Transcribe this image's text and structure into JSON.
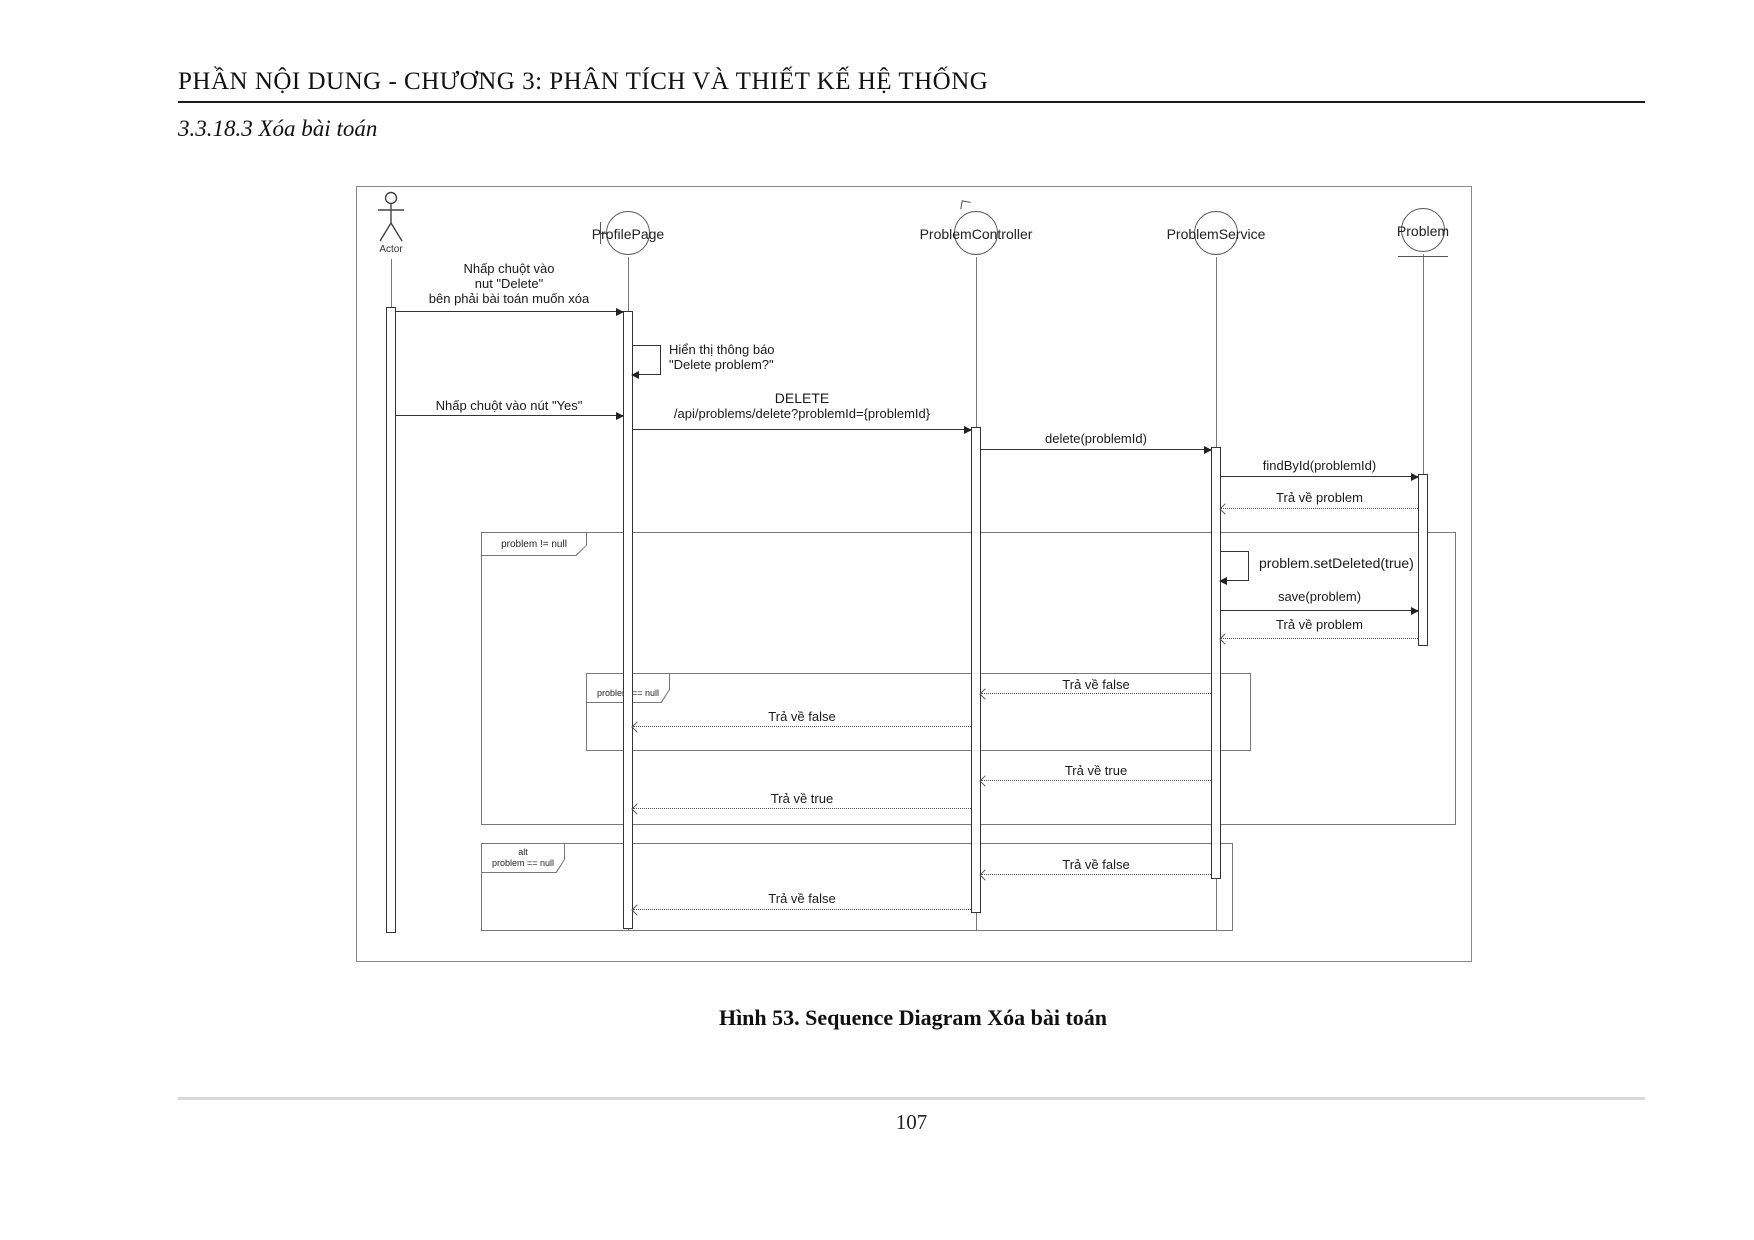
{
  "page": {
    "header": "PHẦN NỘI DUNG - CHƯƠNG 3: PHÂN TÍCH VÀ THIẾT KẾ HỆ THỐNG",
    "section_title": "3.3.18.3 Xóa bài toán",
    "caption": "Hình 53. Sequence Diagram Xóa bài toán",
    "page_number": "107"
  },
  "diagram": {
    "participants": {
      "actor": "Actor",
      "profile_page": "ProfilePage",
      "problem_controller": "ProblemController",
      "problem_service": "ProblemService",
      "problem": "Problem"
    },
    "messages": {
      "click_delete_1": "Nhấp chuột vào",
      "click_delete_2": "nut \"Delete\"",
      "click_delete_3": "bên phải bài toán muốn xóa",
      "show_confirm_1": "Hiển thị thông báo",
      "show_confirm_2": "\"Delete problem?\"",
      "click_yes": "Nhấp chuột vào nút \"Yes\"",
      "http_method": "DELETE",
      "http_url": "/api/problems/delete?problemId={problemId}",
      "delete_call": "delete(problemId)",
      "find_by_id": "findById(problemId)",
      "return_problem_1": "Trả về problem",
      "set_deleted": "problem.setDeleted(true)",
      "save": "save(problem)",
      "return_problem_2": "Trả về problem",
      "return_false_1": "Trả về false",
      "return_false_2": "Trả về false",
      "return_true_1": "Trả về true",
      "return_true_2": "Trả về true",
      "return_false_3": "Trả về false",
      "return_false_4": "Trả về false"
    },
    "fragments": {
      "not_null_guard": "problem != null",
      "alt1_operator": "alt",
      "alt1_guard": "problem == null",
      "alt2_operator": "alt",
      "alt2_guard": "problem == null"
    },
    "colors": {
      "line": "#333333",
      "frame_border": "#8a8a8a",
      "text": "#1a1a1a"
    }
  }
}
